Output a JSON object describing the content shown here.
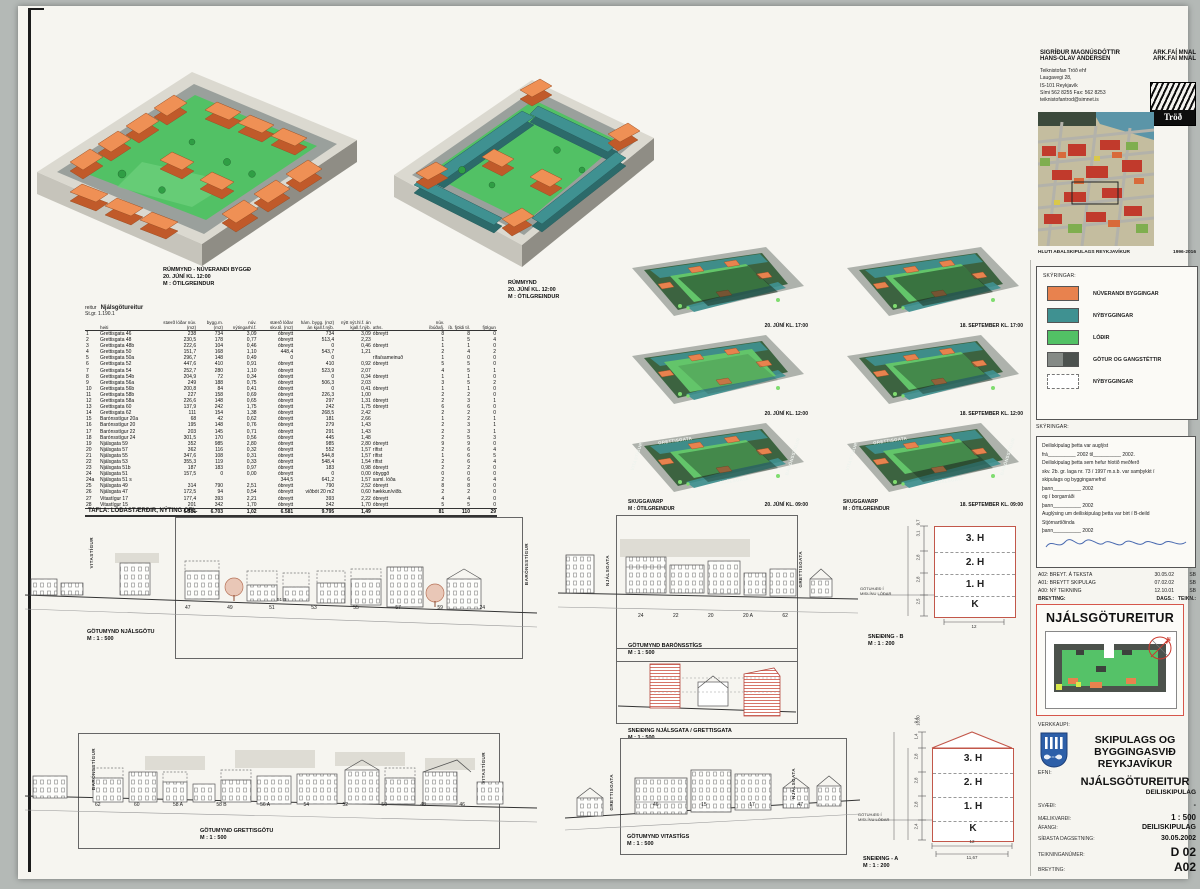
{
  "header": {
    "architects": [
      {
        "name": "SIGRÍÐUR MAGNÚSDÓTTIR",
        "title": "ARK.FAÍ MNAL"
      },
      {
        "name": "HANS-OLAV ANDERSEN",
        "title": "ARK.FAÍ MNAL"
      }
    ],
    "office_lines": [
      "Teiknistofan Tröð ehf",
      "Laugavegi 28,",
      "IS-101 Reykjavík",
      "Sími 562 8255 Fax: 562 8253",
      "teiknistofantrod@simnet.is"
    ],
    "logo": "Tröð"
  },
  "views": {
    "v1": {
      "l1": "RÚMMYND - NÚVERANDI BYGGÐ",
      "l2": "20. JÚNÍ KL. 12:00",
      "l3": "M : ÓTILGREINDUR"
    },
    "v2": {
      "l1": "RÚMMYND",
      "l2": "20. JÚNÍ KL. 12:00",
      "l3": "M : ÓTILGREINDUR"
    }
  },
  "map": {
    "caption": "HLUTI AÐALSKIPULAGS REYKJAVÍKUR",
    "years": "1996-2016"
  },
  "legend": {
    "title": "SKÝRINGAR:",
    "items": [
      {
        "label": "NÚVERANDI BYGGINGAR",
        "color": "#e8824e"
      },
      {
        "label": "NÝBYGGINGAR",
        "color": "#3f9191"
      },
      {
        "label": "LÓÐIR",
        "color": "#52c165"
      },
      {
        "label": "GÖTUR OG GANGSTÉTTIR",
        "color": "#858a86",
        "color2": "#4d524f"
      },
      {
        "label": "NÝBYGGINGAR",
        "color": "#ffffff",
        "dashed": true
      }
    ]
  },
  "notes": {
    "title": "SKÝRINGAR:",
    "lines": [
      "Deiliskipulag þetta var auglýst",
      "frá__________ 2002 til__________ 2002.",
      "Deiliskipulag þetta sem hefur hlotið meðferð",
      "skv. 2b. gr. laga  nr. 73 / 1997 m.s.b. var samþykkt í",
      "skipulags og byggingarnefnd",
      "þann__________ 2002",
      "og í borgarráði",
      "þann__________ 2002",
      "Auglýsing um deiliskipulag þetta var birt í B-deild",
      "Stjórnartíðinda",
      "þann__________ 2002"
    ]
  },
  "revisions": {
    "rows": [
      {
        "desc": "A02: BREYT. Á TEKSTA",
        "date": "30.05.02",
        "init": "SB"
      },
      {
        "desc": "A01: BREYTT SKIPULAG",
        "date": "07.02.02",
        "init": "SB"
      },
      {
        "desc": "A00: NÝ TEIKNING",
        "date": "12.10.01",
        "init": "SB"
      }
    ],
    "footer": {
      "c1": "BREYTING:",
      "c2": "DAGS.:",
      "c3": "TEIKN.:"
    }
  },
  "project_box": {
    "title": "NJÁLSGÖTUREITUR"
  },
  "client": {
    "label": "VERKKAUPI:",
    "name1": "SKIPULAGS OG",
    "name2": "BYGGINGASVIÐ",
    "name3": "REYKJAVÍKUR"
  },
  "subject": {
    "label": "EFNI:",
    "title": "NJÁLSGÖTUREITUR",
    "subtitle": "DEILISKIPULAG"
  },
  "fields": [
    {
      "label": "SVÆÐI:",
      "value": "-"
    },
    {
      "label": "MÆLIKVARÐI:",
      "value": "1 : 500"
    },
    {
      "label": "ÁFANGI:",
      "value": "DEILISKIPULAG"
    },
    {
      "label": "SÍÐASTA DAGSETNING:",
      "value": "30.05.2002"
    },
    {
      "label": "TEIKNINGANÚMER:",
      "value": "D 02"
    },
    {
      "label": "BREYTING:",
      "value": "A02"
    }
  ],
  "table": {
    "label": "reitur",
    "name": "Njálsgötureitur",
    "stgr": "St.gr. 1.190.1",
    "caption": "TAFLA: LÓÐASTÆRÐIR, NÝTING OFL.",
    "headers": [
      "",
      "heiti",
      "stærð lóðar núv. (m2)",
      "bygg.m. (m2)",
      "núv. nýtingarhl.f.",
      "stærð lóðar skv.til. (m2)",
      "hám. bygg. (m2) án kjall.f.nýb.",
      "nýtt nýt.hl.f. án kjall.f.nýb.",
      "aths.",
      "núv. íbúðafj.",
      "íb. fjöldi til.",
      "fjölgun"
    ],
    "rows": [
      [
        "1",
        "Grettisgata 46",
        "238",
        "734",
        "3,09",
        "óbreytt",
        "734",
        "3,09",
        "óbreytt",
        "8",
        "8",
        "0"
      ],
      [
        "2",
        "Grettisgata 48",
        "230,5",
        "178",
        "0,77",
        "óbreytt",
        "513,4",
        "2,23",
        "",
        "1",
        "5",
        "4"
      ],
      [
        "3",
        "Grettisgata 48b",
        "222,6",
        "104",
        "0,46",
        "óbreytt",
        "0",
        "0,46",
        "óbreytt",
        "1",
        "1",
        "0"
      ],
      [
        "4",
        "Grettisgata 50",
        "151,7",
        "168",
        "1,10",
        "448,4",
        "543,7",
        "1,21",
        "",
        "2",
        "4",
        "2"
      ],
      [
        "5",
        "Grettisgata 50a",
        "296,7",
        "148",
        "0,49",
        "0",
        "0",
        "",
        "rífa/sameinuð",
        "1",
        "0",
        "0"
      ],
      [
        "6",
        "Grettisgata 52",
        "447,6",
        "410",
        "0,91",
        "óbreytt",
        "410",
        "0,92",
        "óbreytt",
        "5",
        "5",
        "0"
      ],
      [
        "7",
        "Grettisgata 54",
        "252,7",
        "280",
        "1,10",
        "óbreytt",
        "523,9",
        "2,07",
        "",
        "4",
        "5",
        "1"
      ],
      [
        "8",
        "Grettisgata 54b",
        "204,9",
        "72",
        "0,34",
        "óbreytt",
        "0",
        "0,34",
        "óbreytt",
        "1",
        "1",
        "0"
      ],
      [
        "9",
        "Grettisgata 56a",
        "249",
        "188",
        "0,75",
        "óbreytt",
        "506,3",
        "2,03",
        "",
        "3",
        "5",
        "2"
      ],
      [
        "10",
        "Grettisgata 56b",
        "200,8",
        "84",
        "0,41",
        "óbreytt",
        "0",
        "0,41",
        "óbreytt",
        "1",
        "1",
        "0"
      ],
      [
        "11",
        "Grettisgata 58b",
        "227",
        "158",
        "0,69",
        "óbreytt",
        "226,3",
        "1,00",
        "",
        "2",
        "2",
        "0"
      ],
      [
        "12",
        "Grettisgata 58a",
        "226,6",
        "148",
        "0,65",
        "óbreytt",
        "297",
        "1,31",
        "óbreytt",
        "2",
        "3",
        "1"
      ],
      [
        "13",
        "Grettisgata 60",
        "137,9",
        "242",
        "1,75",
        "óbreytt",
        "242",
        "1,75",
        "óbreytt",
        "6",
        "6",
        "0"
      ],
      [
        "14",
        "Grettisgata 62",
        "111",
        "154",
        "1,38",
        "óbreytt",
        "268,5",
        "2,42",
        "",
        "2",
        "2",
        "0"
      ],
      [
        "15",
        "Barónsstígur 20a",
        "68",
        "42",
        "0,62",
        "óbreytt",
        "181",
        "2,66",
        "",
        "1",
        "2",
        "1"
      ],
      [
        "16",
        "Barónsstígur 20",
        "195",
        "148",
        "0,76",
        "óbreytt",
        "279",
        "1,43",
        "",
        "2",
        "3",
        "1"
      ],
      [
        "17",
        "Barónsstígur 22",
        "203",
        "145",
        "0,71",
        "óbreytt",
        "291",
        "1,43",
        "",
        "2",
        "3",
        "1"
      ],
      [
        "18",
        "Barónsstígur 24",
        "301,5",
        "170",
        "0,56",
        "óbreytt",
        "445",
        "1,48",
        "",
        "2",
        "5",
        "3"
      ],
      [
        "19",
        "Njálsgata 59",
        "352",
        "985",
        "2,80",
        "óbreytt",
        "985",
        "2,80",
        "óbreytt",
        "9",
        "9",
        "0"
      ],
      [
        "20",
        "Njálsgata 57",
        "362",
        "116",
        "0,32",
        "óbreytt",
        "552",
        "1,57",
        "rífist",
        "2",
        "6",
        "4"
      ],
      [
        "21",
        "Njálsgata 55",
        "347,6",
        "108",
        "0,31",
        "óbreytt",
        "544,8",
        "1,57",
        "rífist",
        "1",
        "6",
        "5"
      ],
      [
        "22",
        "Njálsgata 53",
        "355,3",
        "119",
        "0,33",
        "óbreytt",
        "548,4",
        "1,54",
        "rífist",
        "2",
        "6",
        "4"
      ],
      [
        "23",
        "Njálsgata 51b",
        "187",
        "183",
        "0,97",
        "óbreytt",
        "183",
        "0,98",
        "óbreytt",
        "2",
        "2",
        "0"
      ],
      [
        "24",
        "Njálsgata 51",
        "157,5",
        "0",
        "0,00",
        "óbreytt",
        "0",
        "0,00",
        "óbyggð",
        "0",
        "0",
        "0"
      ],
      [
        "24a",
        "Njálsgata 51 s",
        "",
        "",
        "",
        "344,5",
        "641,2",
        "1,57",
        "saml. lóða",
        "2",
        "6",
        "4"
      ],
      [
        "25",
        "Njálsgata 49",
        "314",
        "790",
        "2,51",
        "óbreytt",
        "790",
        "2,52",
        "óbreytt",
        "8",
        "8",
        "0"
      ],
      [
        "26",
        "Njálsgata 47",
        "172,5",
        "94",
        "0,54",
        "óbreytt",
        "viðbót 20 m2",
        "0,60",
        "hækkun/viðb.",
        "2",
        "2",
        "0"
      ],
      [
        "27",
        "Vitastígur 17",
        "177,4",
        "393",
        "2,21",
        "óbreytt",
        "393",
        "2,22",
        "óbreytt",
        "4",
        "4",
        "0"
      ],
      [
        "28",
        "Vitastígur 15",
        "201",
        "342",
        "1,70",
        "óbreytt",
        "342",
        "1,70",
        "óbreytt",
        "5",
        "5",
        "0"
      ]
    ],
    "totals": [
      "",
      "",
      "6.581",
      "6.703",
      "1,02",
      "",
      "9.795",
      "1,49",
      "",
      "81",
      "110",
      "29"
    ],
    "totals_lot_prop": "6.581"
  },
  "shadow": {
    "p1": "20. JÚNÍ KL. 17:00",
    "p2": "18. SEPTEMBER KL. 17:00",
    "p3": "20. JÚNÍ KL. 12:00",
    "p4": "18. SEPTEMBER KL. 12:00",
    "p5": "20. JÚNÍ KL. 09:00",
    "p6": "18. SEPTEMBER KL. 09:00",
    "skuggavarp": "SKUGGAVARP",
    "scale": "M : ÓTILGREINDUR",
    "streets": {
      "top": "GRETTISGATA",
      "left": "VITASTÍGUR",
      "right": "BARÓNSSTÍGUR",
      "bottom": "NJÁLSGATA"
    }
  },
  "elevations": {
    "njalsgata": {
      "title": "GÖTUMYND NJÁLSGÖTU",
      "scale": "M : 1 : 500",
      "left_street": "VITASTÍGUR",
      "right_street": "BARÓNSSTÍGUR",
      "note": "51 B",
      "numbers": [
        "47",
        "49",
        "51",
        "53",
        "55",
        "57",
        "59",
        "24"
      ]
    },
    "baronsstigur": {
      "title": "GÖTUMYND BARÓNSSTÍGS",
      "scale": "M : 1 : 500",
      "left_street": "NJÁLSGATA",
      "right_street": "GRETTISGATA",
      "numbers": [
        "24",
        "22",
        "20",
        "20 A",
        "62"
      ]
    },
    "grettisgata": {
      "title": "GÖTUMYND GRETTISGÖTU",
      "scale": "M : 1 : 500",
      "left_street": "BARÓNSSTÍGUR",
      "right_street": "VITASTÍGUR",
      "numbers": [
        "62",
        "60",
        "58 A",
        "58 B",
        "56 A",
        "54",
        "52",
        "50",
        "48",
        "46"
      ]
    },
    "vitastigur": {
      "title": "GÖTUMYND VITASTÍGS",
      "scale": "M : 1 : 500",
      "left_street": "GRETTISGATA",
      "right_street": "NJÁLSGATA",
      "numbers": [
        "46",
        "15",
        "17",
        "47"
      ]
    }
  },
  "sections": {
    "cut": {
      "title": "SNEIÐING NJÁLSGATA / GRETTISGATA",
      "scale": "M : 1 : 500"
    },
    "b": {
      "title": "SNEIÐING - B",
      "scale": "M : 1 : 200",
      "floors": [
        "3. H",
        "2. H",
        "1. H",
        "K"
      ],
      "dims": [
        "3,1",
        "2,8",
        "2,8",
        "2,5"
      ],
      "total": "9,7",
      "width": "12",
      "ground_note1": "GÖTUHÆÐ Í",
      "ground_note2": "MIÐLÍNU LÓÐAR"
    },
    "a": {
      "title": "SNEIÐING - A",
      "scale": "M : 1 : 200",
      "floors": [
        "3. H",
        "2. H",
        "1. H",
        "K"
      ],
      "dims": [
        "1,4",
        "2,8",
        "2,8",
        "2,8",
        "2,4"
      ],
      "total": "10,80",
      "total2": "9,4",
      "width": "12",
      "width2": "11,67",
      "ground_note1": "GÖTUHÆÐ Í",
      "ground_note2": "MIÐLÍNU LÓÐAR"
    }
  }
}
